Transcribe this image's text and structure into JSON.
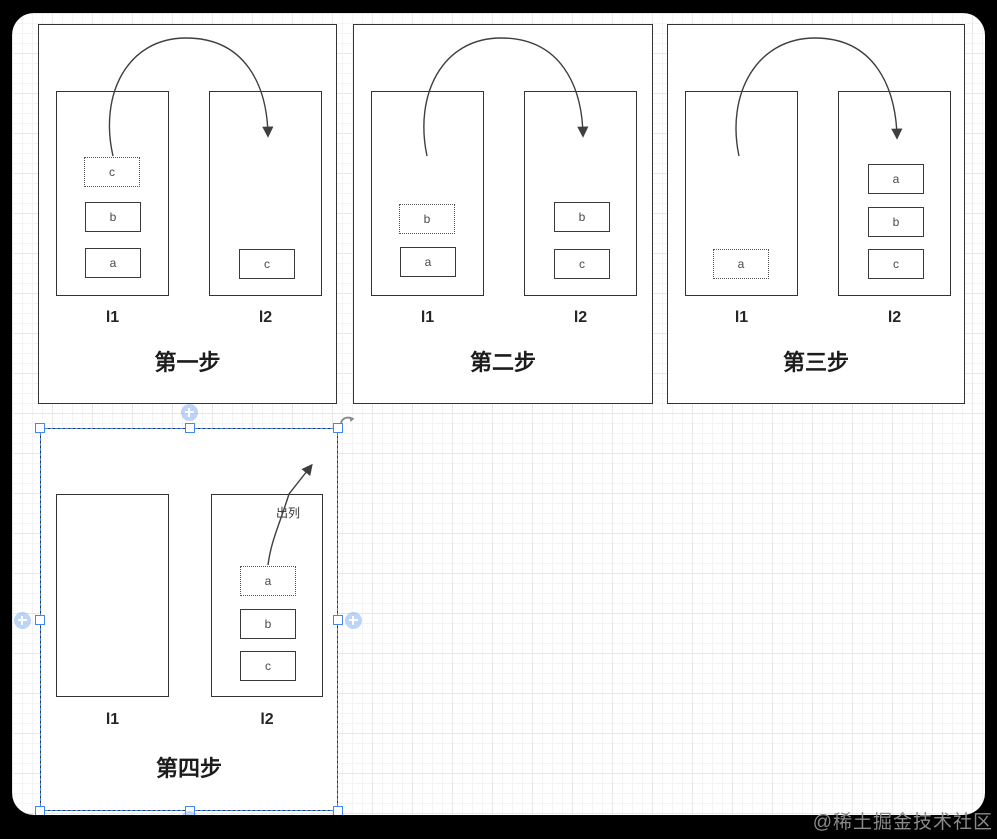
{
  "app": {
    "type": "diagram-editor-canvas"
  },
  "watermark": {
    "text": "@稀土掘金技术社区"
  },
  "panels": [
    {
      "step_label": "第一步",
      "l1_label": "l1",
      "l2_label": "l2",
      "l1_boxes": [
        {
          "text": "c",
          "style": "dotted"
        },
        {
          "text": "b",
          "style": "solid"
        },
        {
          "text": "a",
          "style": "solid"
        }
      ],
      "l2_boxes": [
        {
          "text": "c",
          "style": "solid"
        }
      ]
    },
    {
      "step_label": "第二步",
      "l1_label": "l1",
      "l2_label": "l2",
      "l1_boxes": [
        {
          "text": "b",
          "style": "dotted"
        },
        {
          "text": "a",
          "style": "solid"
        }
      ],
      "l2_boxes": [
        {
          "text": "b",
          "style": "solid"
        },
        {
          "text": "c",
          "style": "solid"
        }
      ]
    },
    {
      "step_label": "第三步",
      "l1_label": "l1",
      "l2_label": "l2",
      "l1_boxes": [
        {
          "text": "a",
          "style": "dotted"
        }
      ],
      "l2_boxes": [
        {
          "text": "a",
          "style": "solid"
        },
        {
          "text": "b",
          "style": "solid"
        },
        {
          "text": "c",
          "style": "solid"
        }
      ]
    },
    {
      "step_label": "第四步",
      "l1_label": "l1",
      "l2_label": "l2",
      "l1_boxes": [],
      "l2_boxes": [
        {
          "text": "a",
          "style": "dotted"
        },
        {
          "text": "b",
          "style": "solid"
        },
        {
          "text": "c",
          "style": "solid"
        }
      ],
      "edge_label": "出列"
    }
  ],
  "selection": {
    "selected_panel_index": 3,
    "handle_count": 8
  },
  "colors": {
    "selection_blue": "#4285f4",
    "shape_stroke": "#333333",
    "canvas_bg": "#ffffff",
    "frame_bg": "#000000",
    "grid_minor": "#f4f4f7",
    "grid_major": "#e8e8ec"
  }
}
